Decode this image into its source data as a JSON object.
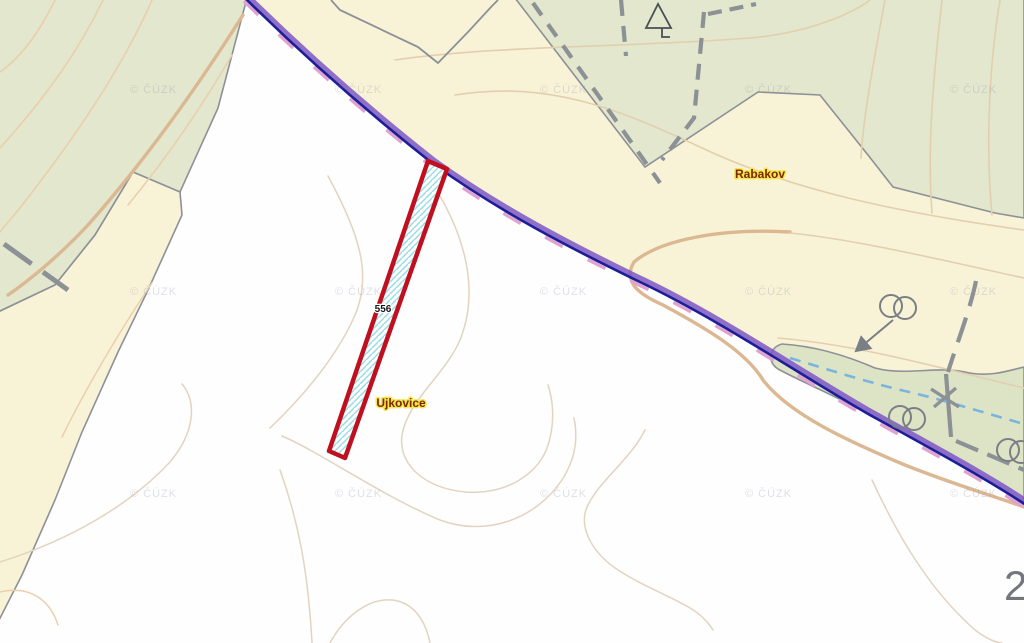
{
  "title": "Cadastral map view",
  "labels": {
    "parcel_number": "556",
    "place_rabakov": "Rabakov",
    "place_ujkovice": "Ujkovice",
    "watermark": "© ČÚZK",
    "sheet_number": "2"
  },
  "icons": [
    "tree-icon",
    "well-icon",
    "well-icon",
    "well-icon",
    "arrow-pointer-icon",
    "culvert-cross-icon"
  ],
  "colors": {
    "field_cream": "#f8f3d7",
    "forest_green": "#e2e7cd",
    "white_ground": "#fefefe",
    "contour_light": "#e3d3bf",
    "contour_mid": "#e9cfae",
    "contour_thick": "#dbb892",
    "boundary_gray": "#8d9196",
    "road_navy": "#1b1e96",
    "cadastre_purple": "#7e57c6",
    "accent_pink": "#e0a3d0",
    "parcel_red": "#c01020",
    "hatch_cyan": "#9adce6",
    "stream_blue": "#79b5de",
    "label_halo_yellow": "#f5e74e",
    "label_text_maroon": "#7b2800"
  }
}
